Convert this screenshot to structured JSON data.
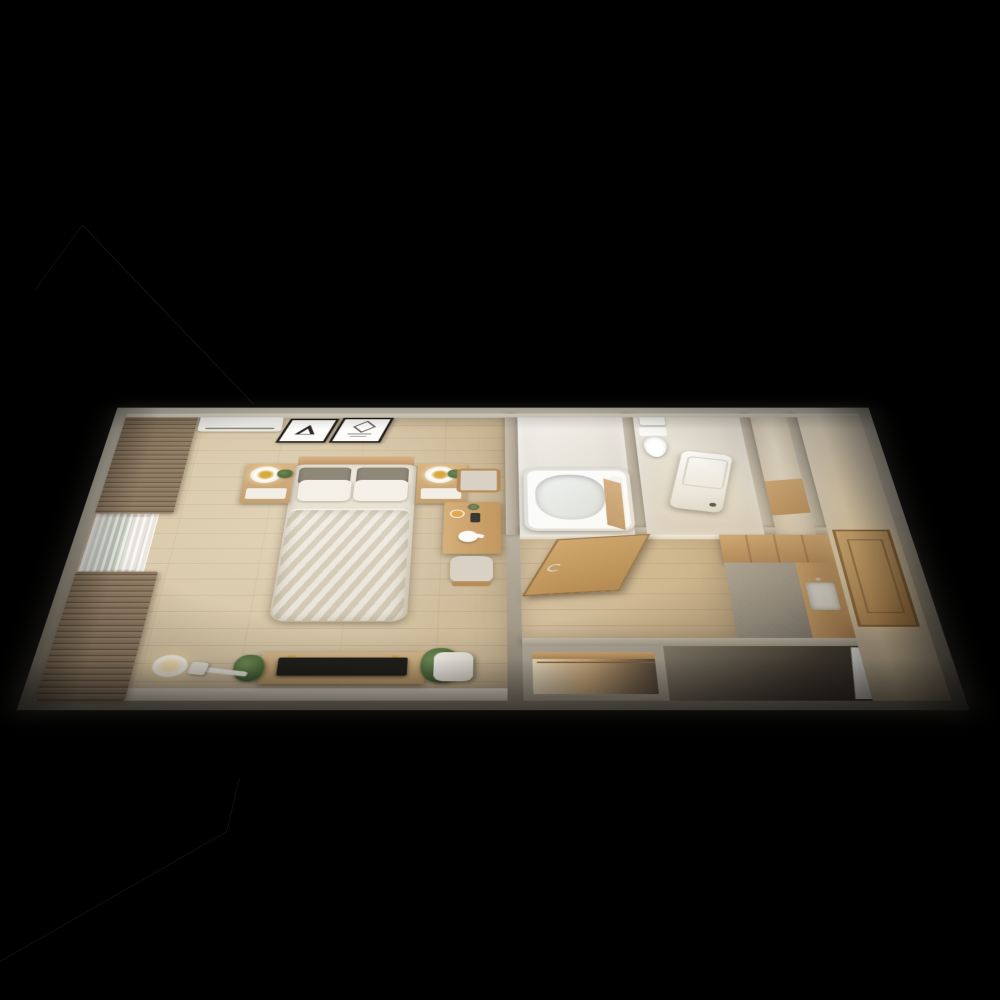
{
  "scene": {
    "description": "Top-down 3D dollhouse render of a narrow one-room apartment floor plan on a black background",
    "view": "isometric top-down, long axis horizontal, perspective widening toward viewer",
    "rooms": [
      {
        "id": "bedroom-living-room",
        "label": "bedroom / living room",
        "features": [
          "wood plank flooring",
          "window wall with brown drapes and white sheer curtain",
          "greenery visible through window"
        ]
      },
      {
        "id": "bathroom",
        "label": "unit bathroom",
        "features": [
          "white bathtub",
          "white wall panels"
        ]
      },
      {
        "id": "toilet-laundry-room",
        "label": "toilet and laundry room",
        "features": [
          "toilet",
          "small hand sink",
          "washing machine"
        ]
      },
      {
        "id": "hallway",
        "label": "hallway",
        "features": [
          "wood flooring",
          "open swing door"
        ]
      },
      {
        "id": "kitchen",
        "label": "kitchen",
        "features": [
          "wood cabinets",
          "gray floor mat",
          "sink with faucet"
        ]
      },
      {
        "id": "closet",
        "label": "closet",
        "features": [
          "shelf",
          "hanging rod",
          "warm interior lighting"
        ]
      },
      {
        "id": "entryway",
        "label": "entryway / genkan",
        "features": [
          "paneled wooden front door",
          "warm downlight glow"
        ]
      }
    ],
    "furniture": [
      "air-conditioner",
      "wall-art-frame-triangle",
      "wall-art-frame-diamond",
      "double-bed",
      "headboard",
      "gray-pillows",
      "white-pillows",
      "duvet",
      "nightstand-left",
      "nightstand-right",
      "ring-table-lamp-left",
      "ring-table-lamp-right",
      "small-potted-plants",
      "dining-table",
      "dining-chair-top",
      "dining-chair-bottom",
      "teapot",
      "plate",
      "coffee-set",
      "flower-vase",
      "tv-console",
      "television",
      "floor-lamp",
      "handheld-vacuum",
      "storage-bin",
      "potted-plant-left-of-tv",
      "monstera-plant-right-of-tv",
      "bathtub",
      "toilet",
      "hand-sink",
      "washing-machine",
      "kitchen-cabinets",
      "kitchen-counter",
      "kitchen-sink",
      "open-interior-door",
      "front-door",
      "closet-shelf",
      "white-door-panel"
    ],
    "background_artifacts": "very faint dark silhouette lines in the black void at upper-left and lower-left"
  },
  "colors": {
    "bg": "#000000",
    "outer-wall": "#c3bbac",
    "outer-wall-dark": "#8e8677",
    "inner-wall": "#ece6d9",
    "wood-floor": "#d5c3a3",
    "wood-floor-dark": "#c9b693",
    "wood-furniture": "#c9a271",
    "curtain-brown": "#8d7a62",
    "curtain-brown-dark": "#6d5b46",
    "sheer-white": "#f2f0ea",
    "window-green": "#5f7a50",
    "window-building": "#cfc9ba",
    "duvet": "#e9e2d3",
    "pillow-gray": "#8f8778",
    "pillow-white": "#f4f0e7",
    "tv-black": "#201f1c",
    "plant-green": "#4e6b3c",
    "lamp-gold": "#d9a93e",
    "white-appliance": "#f6f3ec",
    "bath-white": "#fbfbf9",
    "gray-mat": "#968e82",
    "kitchen-cabinet": "#c89e68",
    "door-wood": "#c8a061",
    "warm-glow": "#ffe2ae",
    "dark-zone": "#3a342b"
  }
}
